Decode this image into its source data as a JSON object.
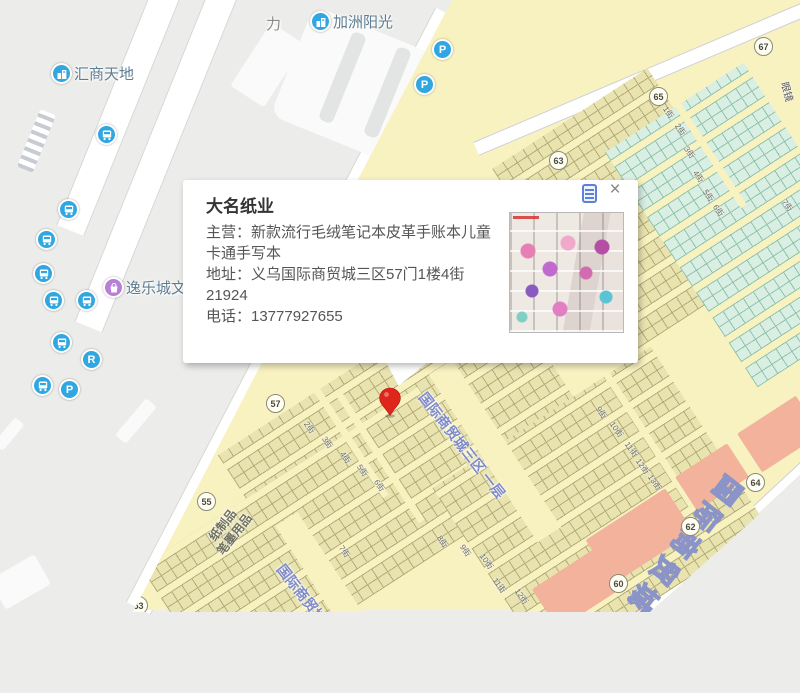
{
  "map": {
    "poi": {
      "huishang": "汇商天地",
      "jiazhou": "加洲阳光",
      "yile": "逸乐城文",
      "li": "力",
      "yanjing": "眼镜"
    },
    "section_label": {
      "line1": "纸制品",
      "line2": "笔墨用品"
    },
    "road_label": "国际商贸城三区 一层",
    "big_label": "国际商贸城",
    "gates": [
      "53",
      "55",
      "57",
      "60",
      "62",
      "63",
      "64",
      "65",
      "67"
    ],
    "streets": [
      "1街",
      "2街",
      "3街",
      "4街",
      "5街",
      "6街",
      "7街",
      "2街",
      "3街",
      "4街",
      "5街",
      "6街",
      "7街",
      "8街",
      "9街",
      "10街",
      "11街",
      "12街",
      "9街",
      "10街",
      "11街",
      "12街",
      "13街"
    ],
    "glyphs": {
      "parking": "P",
      "restroom": "R"
    },
    "colors": {
      "market_yellow": "#f8f2c1",
      "booth_khaki": "#e9e4af",
      "booth_teal": "#d9efe4",
      "salmon": "#f2b29b",
      "transit_blue": "#31a7e1",
      "poi_purple": "#b77fd9",
      "marker_red": "#e0251b",
      "road_label_blue": "#7f8ac8"
    }
  },
  "popup": {
    "title": "大名纸业",
    "lines": [
      "主营：新款流行毛绒笔记本皮革手账本儿童卡通手写本",
      "地址：义乌国际商贸城三区57门1楼4街21924",
      "电话：13777927655"
    ],
    "close": "×"
  }
}
